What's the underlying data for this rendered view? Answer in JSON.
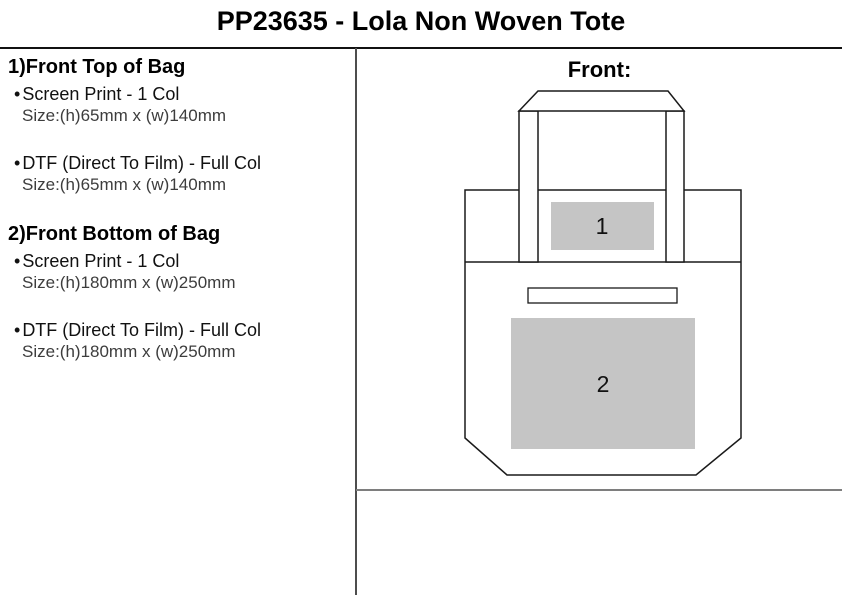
{
  "page_title": "PP23635 - Lola Non Woven Tote",
  "spec_panel": {
    "bullet": "•",
    "sections": [
      {
        "heading": "1)Front Top of Bag",
        "items": [
          {
            "method": "Screen Print - 1 Col",
            "size": "Size:(h)65mm x (w)140mm"
          },
          {
            "method": "DTF (Direct To Film) - Full Col",
            "size": "Size:(h)65mm x (w)140mm"
          }
        ]
      },
      {
        "heading": "2)Front Bottom of Bag",
        "items": [
          {
            "method": "Screen Print - 1 Col",
            "size": "Size:(h)180mm x (w)250mm"
          },
          {
            "method": "DTF (Direct To Film) - Full Col",
            "size": "Size:(h)180mm x (w)250mm"
          }
        ]
      }
    ]
  },
  "diagram": {
    "view_label": "Front:",
    "print_areas": [
      {
        "number": "1"
      },
      {
        "number": "2"
      }
    ],
    "colors": {
      "print_area_fill": "#c5c5c5",
      "outline": "#1a1a1a",
      "panel_divider": "#4d4d4d",
      "bottom_rule": "#7e7e7e",
      "title_rule": "#111111"
    }
  }
}
